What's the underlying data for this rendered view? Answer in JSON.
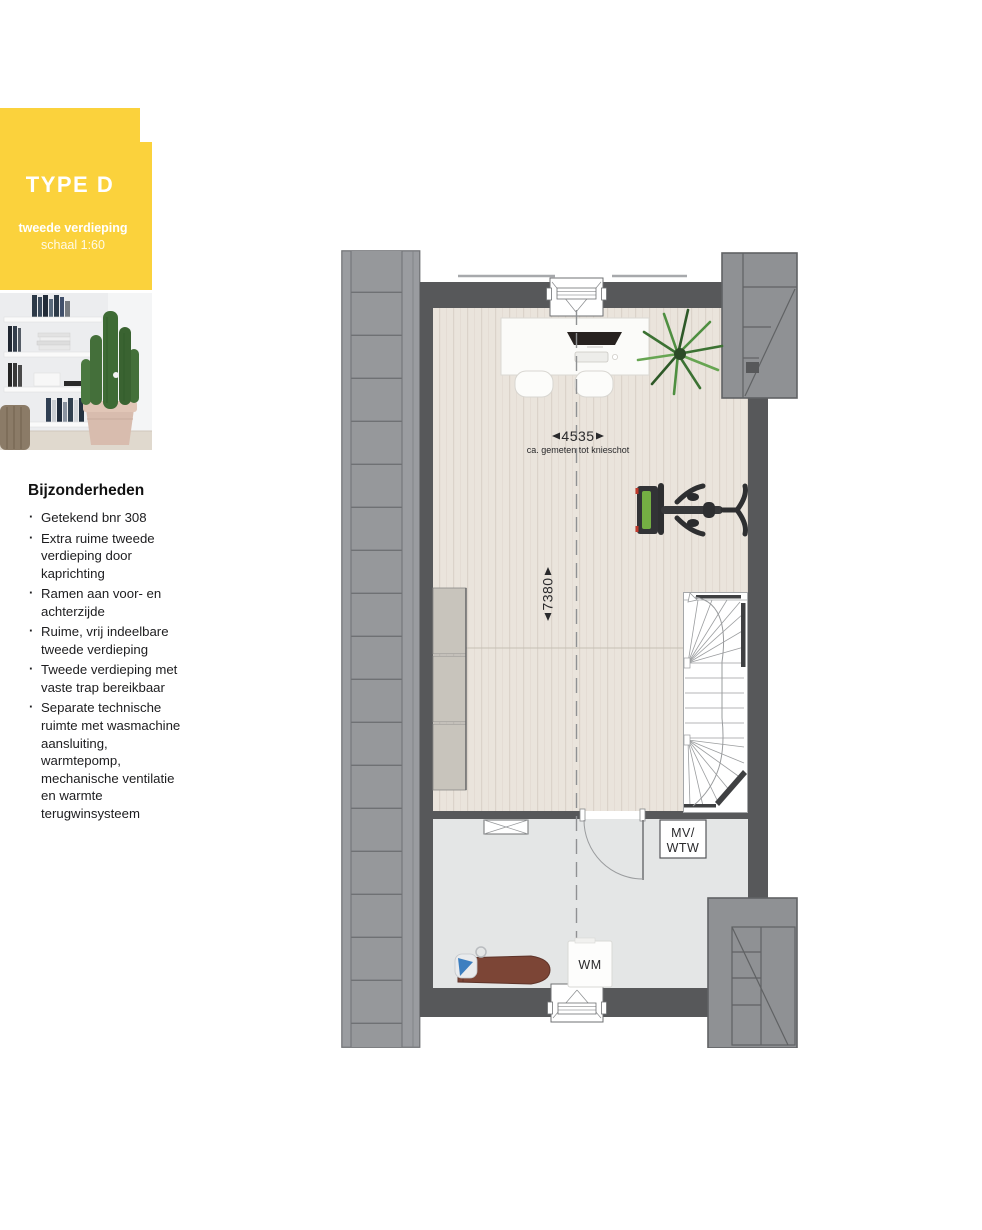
{
  "panel": {
    "type_label": "TYPE D",
    "subtitle_line1": "tweede verdieping",
    "subtitle_line2": "schaal 1:60",
    "accent_color": "#FBD23C"
  },
  "details": {
    "heading": "Bijzonderheden",
    "items": [
      "Getekend bnr 308",
      "Extra ruime tweede verdieping door kaprichting",
      "Ramen aan voor- en achterzijde",
      "Ruime, vrij indeelbare tweede verdieping",
      "Tweede verdieping met vaste trap bereikbaar",
      "Separate technische ruimte met wasmachine aansluiting, warmtepomp, mechanische ventilatie en warmte terugwinsysteem"
    ]
  },
  "plan": {
    "dim_width": "4535",
    "dim_width_note": "ca. gemeten tot knieschot",
    "dim_depth": "7380",
    "room_labels": {
      "mv": "MV/",
      "wtw": "WTW",
      "wm": "WM"
    },
    "colors": {
      "wall": "#57585A",
      "roof": "#95979A",
      "wood_floor": "#EAE4DC",
      "tech_floor": "#E4E6E6"
    }
  }
}
